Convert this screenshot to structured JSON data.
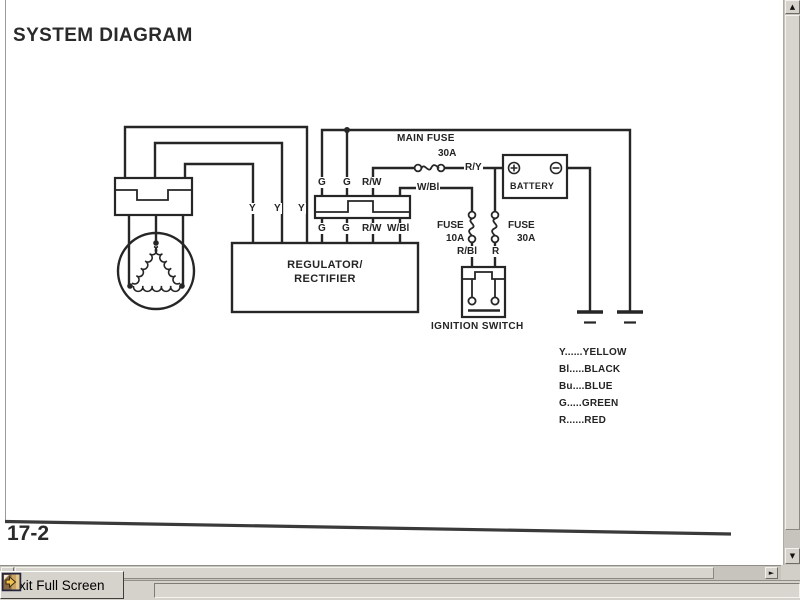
{
  "page": {
    "title": "SYSTEM DIAGRAM",
    "page_number": "17-2"
  },
  "diagram": {
    "regulator_line1": "REGULATOR/",
    "regulator_line2": "RECTIFIER",
    "battery": "BATTERY",
    "ignition_switch": "IGNITION SWITCH",
    "main_fuse_line1": "MAIN FUSE",
    "main_fuse_line2": "30A",
    "fuse_left_line1": "FUSE",
    "fuse_left_line2": "10A",
    "fuse_right_line1": "FUSE",
    "fuse_right_line2": "30A",
    "labels": {
      "y1": "Y",
      "y2": "Y",
      "y3": "Y",
      "g_top1": "G",
      "g_top2": "G",
      "rw_top": "R/W",
      "g_bot1": "G",
      "g_bot2": "G",
      "rw_bot": "R/W",
      "wbl_bot": "W/Bl",
      "wbl_wire": "W/Bl",
      "ry": "R/Y",
      "rbl": "R/Bl",
      "r": "R"
    },
    "legend": [
      "Y......YELLOW",
      "Bl.....BLACK",
      "Bu....BLUE",
      "G.....GREEN",
      "R......RED"
    ]
  },
  "chrome": {
    "exit_button_label": "Exit Full Screen",
    "up_arrow": "▲",
    "down_arrow": "▼",
    "left_arrow": "◄",
    "right_arrow": "►"
  },
  "colors": {
    "ink": "#262626",
    "chrome_bg": "#d6d3cc",
    "icon_gold": "#f0c050"
  }
}
